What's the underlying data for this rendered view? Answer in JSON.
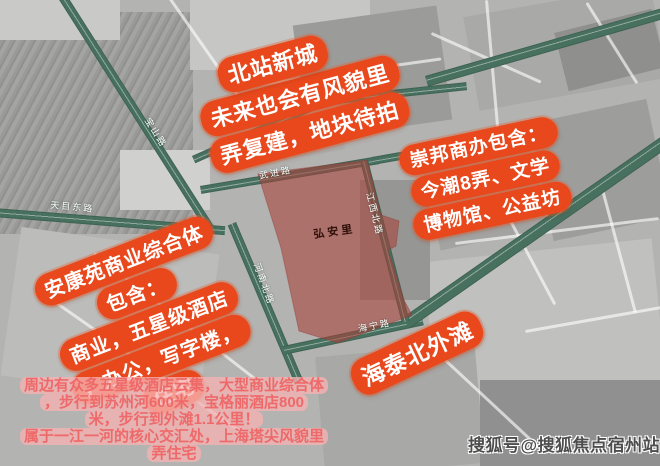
{
  "map": {
    "parcel_label": "弘安里",
    "roads": [
      {
        "id": "tianmu-east",
        "label": "天目东路"
      },
      {
        "id": "baoshan",
        "label": "宝山路"
      },
      {
        "id": "dongxinmin",
        "label": "东新民路"
      },
      {
        "id": "wujin",
        "label": "武进路"
      },
      {
        "id": "jiangxi-north",
        "label": "江西北路"
      },
      {
        "id": "henan-north",
        "label": "河南北路"
      },
      {
        "id": "haining",
        "label": "海宁路"
      }
    ]
  },
  "annotations": {
    "north_bubble": {
      "lines": [
        "北站新城",
        "未来也会有风貌里",
        "弄复建，地块待拍"
      ]
    },
    "east_bubble": {
      "lines": [
        "崇邦商办包含：",
        "今潮8弄、文学",
        "博物馆、公益坊"
      ]
    },
    "west_bubble": {
      "lines": [
        "安康苑商业综合体",
        "包含：",
        "商业，五星级酒店",
        "，办公，写字楼，",
        "住宅"
      ]
    },
    "southeast_bubble": {
      "lines": [
        "海泰北外滩"
      ]
    },
    "bottom_note": {
      "lines": [
        "周边有众多五星级酒店云集，大型商业综合体",
        "，步行到苏州河600米，宝格丽酒店800",
        "米，步行到外滩1.1公里！",
        "属于一江一河的核心交汇处，上海塔尖风貌里",
        "弄住宅"
      ]
    }
  },
  "watermark": "搜狐号@搜狐焦点宿州站",
  "colors": {
    "bubble_orange": "#e8481c",
    "bubble_text": "#ffffff",
    "road_green": "#47705f",
    "road_label_text": "#ffffff",
    "parcel_red": "#a8423a",
    "parcel_label_text": "#30100a",
    "bottom_note_text": "#ee6a6a",
    "bottom_note_bg": "#f6b2b2",
    "watermark_text": "#4d4d4d"
  }
}
